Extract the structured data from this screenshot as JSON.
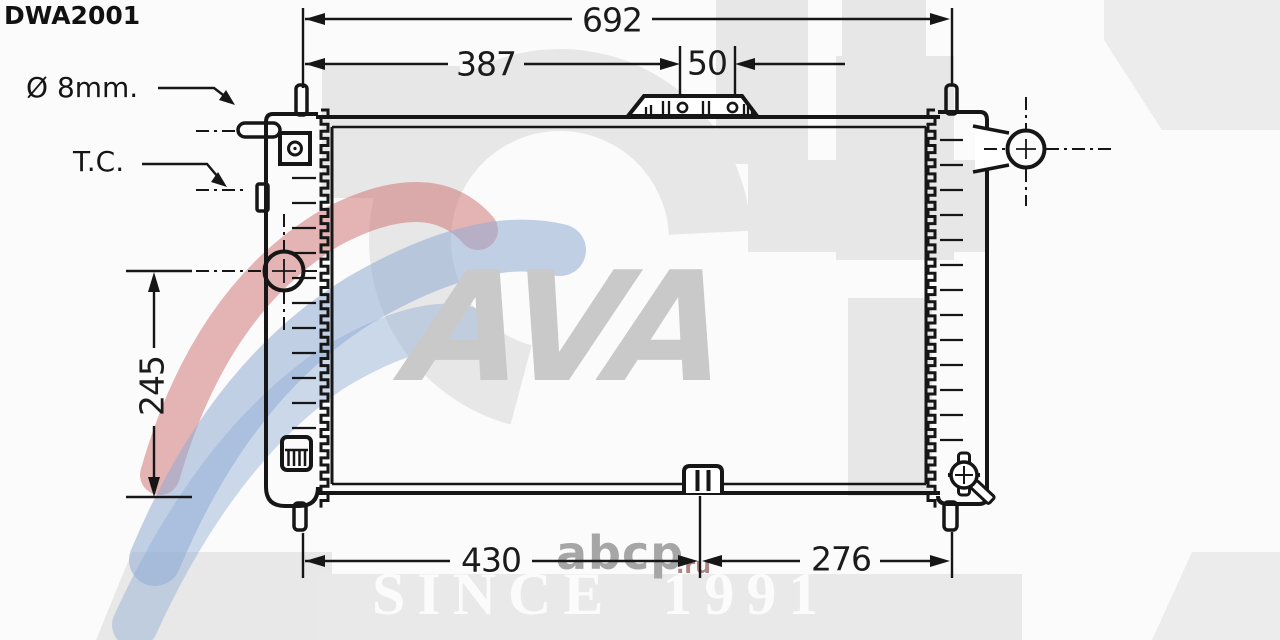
{
  "part_number": "DWA2001",
  "callouts": {
    "pipe_diameter": "Ø 8mm.",
    "thermo_contact": "T.C."
  },
  "dimensions": {
    "overall_width": "692",
    "upper_width": "387",
    "bracket_spacing": "50",
    "core_height": "245",
    "bottom_left_width": "430",
    "bottom_right_width": "276"
  },
  "watermark": {
    "brand": "AVA",
    "since": "SINCE 1991",
    "site_name": "abcp",
    "site_domain": ".ru"
  },
  "colors": {
    "line": "#161616",
    "watermark_gray": "#e7e7e7",
    "swoosh_red": "rgba(205,110,110,0.5)",
    "swoosh_blue": "rgba(145,172,212,0.55)"
  }
}
